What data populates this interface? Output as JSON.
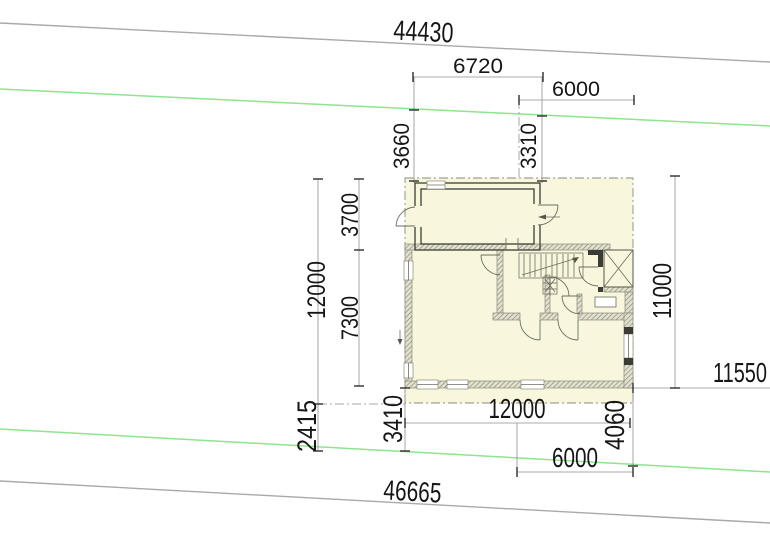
{
  "drawing": {
    "type": "architectural-site-plan",
    "dimensions": {
      "top_total": "44430",
      "top_seg_left": "6720",
      "top_seg_right": "6000",
      "offset_front_left": "3660",
      "offset_front_right": "3310",
      "depth_total_left": "12000",
      "depth_upper": "3700",
      "depth_lower": "7300",
      "depth_total_right": "11000",
      "offset_right": "11550",
      "offset_rear_gap": "2415",
      "offset_rear_left": "3410",
      "width_building": "12000",
      "width_rear_right": "6000",
      "offset_rear_right": "4060",
      "bottom_total": "46665"
    },
    "colors": {
      "boundary_gray": "#a9a9a9",
      "plot_green": "#8fe48f",
      "building_fill": "#f8f7dd",
      "wall_dark": "#3c3c34",
      "hatch_edge": "#8a8a7c",
      "hatch_line": "#85857a",
      "dim_line": "#8f8f8f",
      "dim_text": "#161616"
    }
  }
}
